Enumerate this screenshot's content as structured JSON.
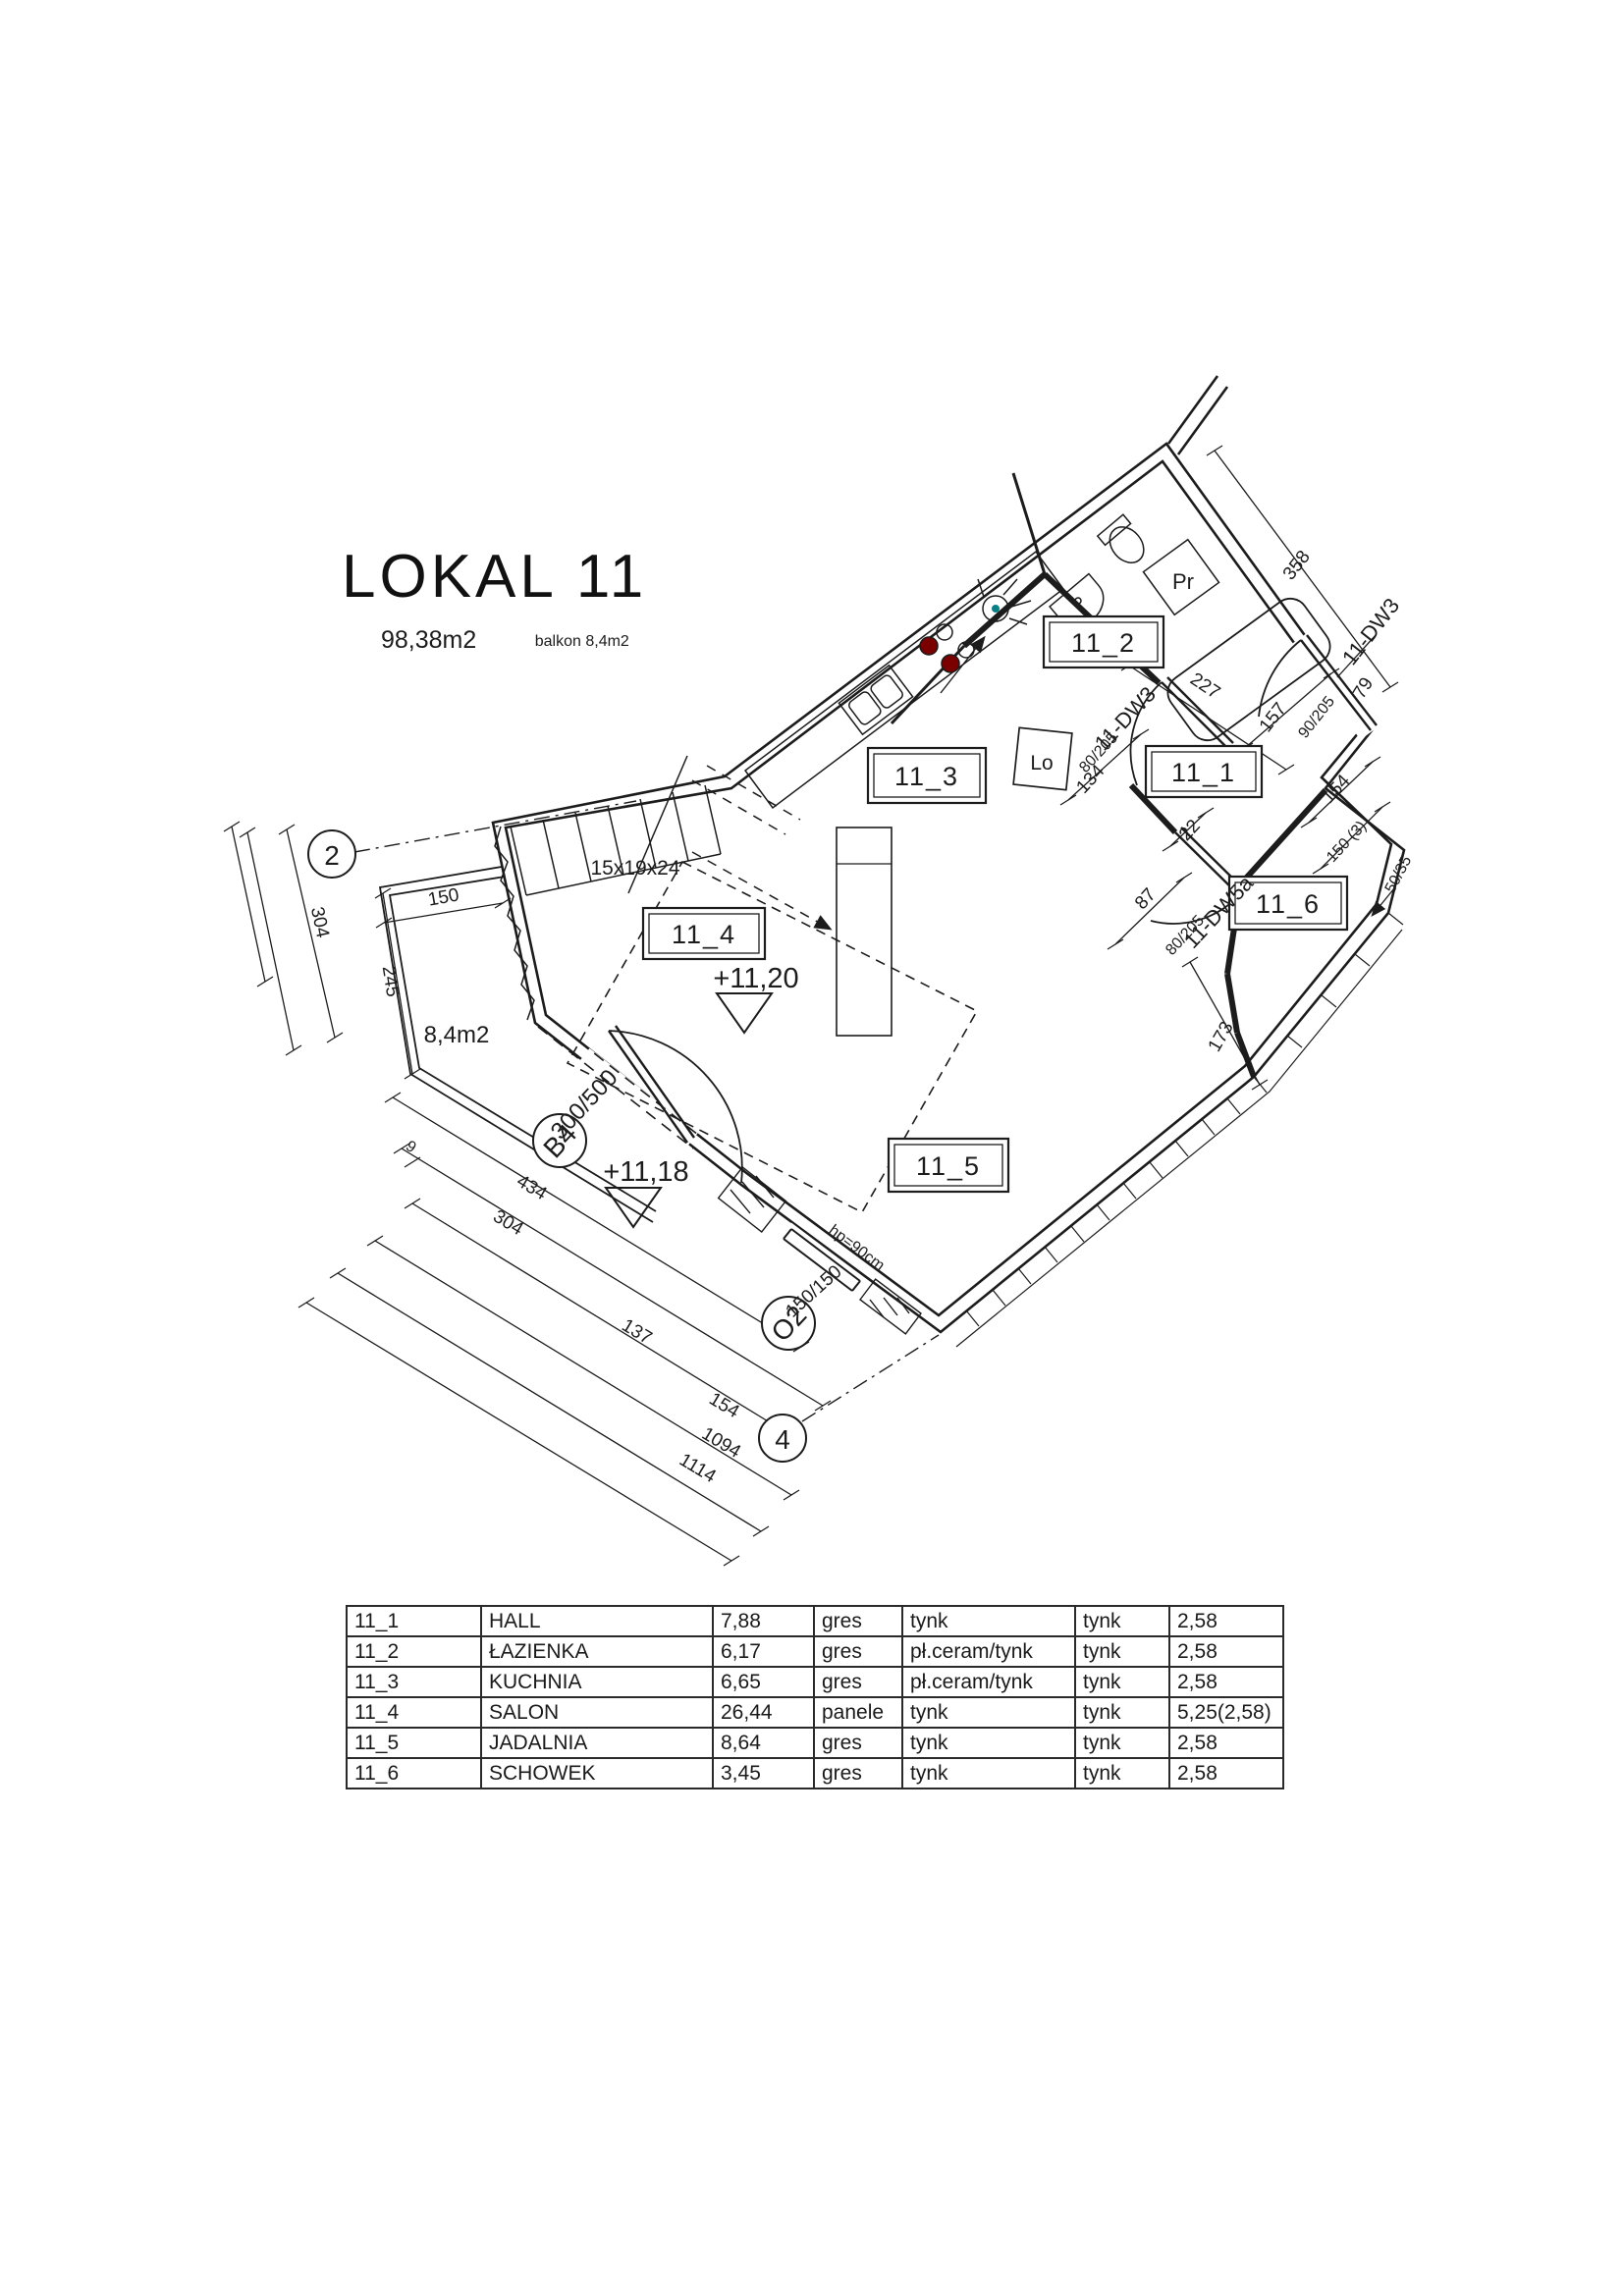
{
  "title": {
    "name": "LOKAL 11",
    "area": "98,38m2",
    "balcony": "balkon 8,4m2"
  },
  "plan": {
    "rooms": [
      "11_1",
      "11_2",
      "11_3",
      "11_4",
      "11_5",
      "11_6"
    ],
    "levels": {
      "salon": "+11,20",
      "dining": "+11,18"
    },
    "balcony_area": "8,4m2",
    "stairs": "15x19x24",
    "fridge": "Lo",
    "washer": "Pr",
    "axis": {
      "a2": "2",
      "a4": "4"
    },
    "windows": {
      "b4": "B4",
      "o2": "O2"
    },
    "doors": {
      "entry_name": "11-DW3",
      "entry_size": "90/205",
      "hall_name": "11-DW3",
      "hall_size": "80/205",
      "closet_name": "11-DW5a",
      "closet_size": "80/205"
    },
    "dims": {
      "d227": "227",
      "d358": "358",
      "d157": "157",
      "d79": "79",
      "d134": "134",
      "d22": "22",
      "d87": "87",
      "d173": "173",
      "d154r": "154",
      "d150r": "150 (3)",
      "d5035": "50/35",
      "d304l": "304",
      "d245": "245",
      "d150b": "150",
      "d300500": "300/500",
      "d150150": "150/150",
      "hp": "hp=90cm",
      "d434": "434",
      "d9": "9",
      "d304b": "304",
      "d137": "137",
      "d154b": "154",
      "d1094": "1094",
      "d1114": "1114"
    }
  },
  "table": {
    "rows": [
      {
        "id": "11_1",
        "name": "HALL",
        "area": "7,88",
        "floor": "gres",
        "wall": "tynk",
        "ceiling": "tynk",
        "height": "2,58"
      },
      {
        "id": "11_2",
        "name": "ŁAZIENKA",
        "area": "6,17",
        "floor": "gres",
        "wall": "pł.ceram/tynk",
        "ceiling": "tynk",
        "height": "2,58"
      },
      {
        "id": "11_3",
        "name": "KUCHNIA",
        "area": "6,65",
        "floor": "gres",
        "wall": "pł.ceram/tynk",
        "ceiling": "tynk",
        "height": "2,58"
      },
      {
        "id": "11_4",
        "name": "SALON",
        "area": "26,44",
        "floor": "panele",
        "wall": "tynk",
        "ceiling": "tynk",
        "height": "5,25(2,58)"
      },
      {
        "id": "11_5",
        "name": "JADALNIA",
        "area": "8,64",
        "floor": "gres",
        "wall": "tynk",
        "ceiling": "tynk",
        "height": "2,58"
      },
      {
        "id": "11_6",
        "name": "SCHOWEK",
        "area": "3,45",
        "floor": "gres",
        "wall": "tynk",
        "ceiling": "tynk",
        "height": "2,58"
      }
    ]
  }
}
